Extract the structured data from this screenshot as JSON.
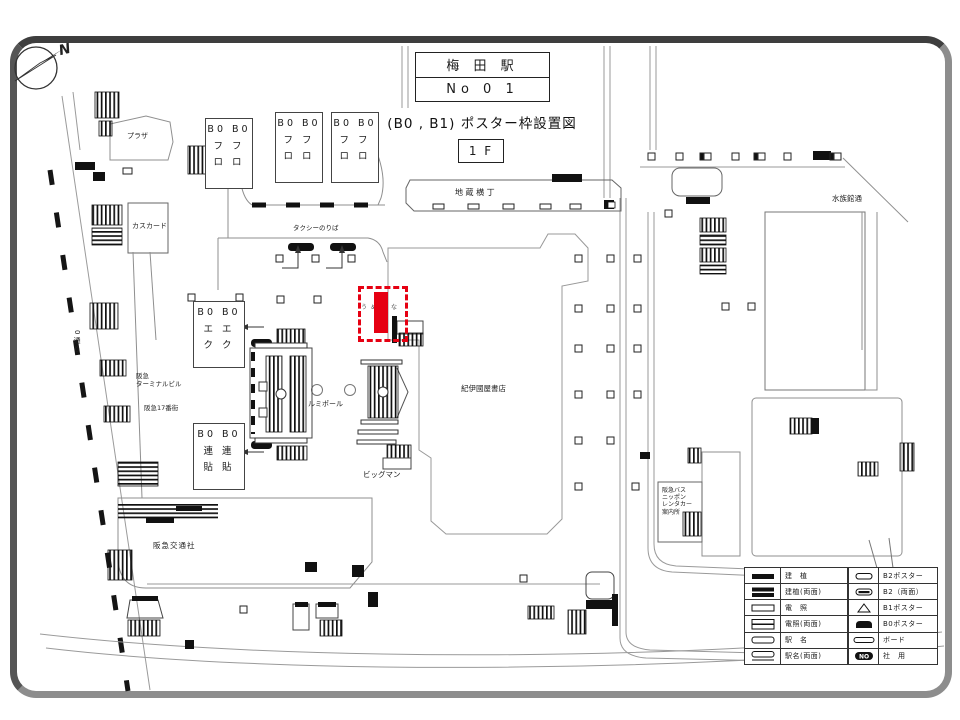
{
  "header": {
    "station": "梅 田 駅",
    "sheet_no": "No  0 1",
    "subtitle": "(B0 , B1) ポスター枠設置図",
    "floor": "1 F"
  },
  "compass": {
    "label": "N"
  },
  "labels": {
    "plaza": "プラザ",
    "cascade": "カスカード",
    "taxi_stand": "タクシーのりば",
    "jizo_yokocho": "地 蔵 横 丁",
    "suizokukan_dori": "水族館通",
    "street_0": "0通り",
    "hankyu_terminal_bldg": "阪急\nターミナルビル",
    "hankyu_17bangai": "阪急17番街",
    "hankyu_kotsusha": "阪急交通社",
    "kinokuniya": "紀伊國屋書店",
    "lumipole": "ルミポール",
    "bigman": "ビッグマン",
    "bus_info": "阪急バス\nニッポン\nレンタカー\n案内所",
    "highlight_name": "うめばな"
  },
  "frame_boxes": {
    "furo": "B0 B0\nフ フ\nロ ロ",
    "eku": "B0 B0\nエ エ\nク ク",
    "renbari": "B0 B0\n連 連\n貼 貼"
  },
  "legend": {
    "left": [
      {
        "symbol": "kenshoku",
        "label": "建　植"
      },
      {
        "symbol": "kenshoku-double",
        "label": "建植(両面)"
      },
      {
        "symbol": "densho",
        "label": "電　照"
      },
      {
        "symbol": "densho-double",
        "label": "電照(両面)"
      },
      {
        "symbol": "ekimei",
        "label": "駅　名"
      },
      {
        "symbol": "ekimei-double",
        "label": "駅名(両面)"
      }
    ],
    "right": [
      {
        "symbol": "b2-poster",
        "label": "B2ポスター"
      },
      {
        "symbol": "b2-double",
        "label": "B2（両面）"
      },
      {
        "symbol": "b1-poster",
        "label": "B1ポスター"
      },
      {
        "symbol": "b0-poster",
        "label": "B0ポスター"
      },
      {
        "symbol": "board",
        "label": "ボード"
      },
      {
        "symbol": "company-use",
        "label": "社　用"
      }
    ],
    "no_badge": "NO"
  },
  "colors": {
    "highlight": "#e60012",
    "outline_gray": "#8f8f8f",
    "ink": "#111111"
  }
}
